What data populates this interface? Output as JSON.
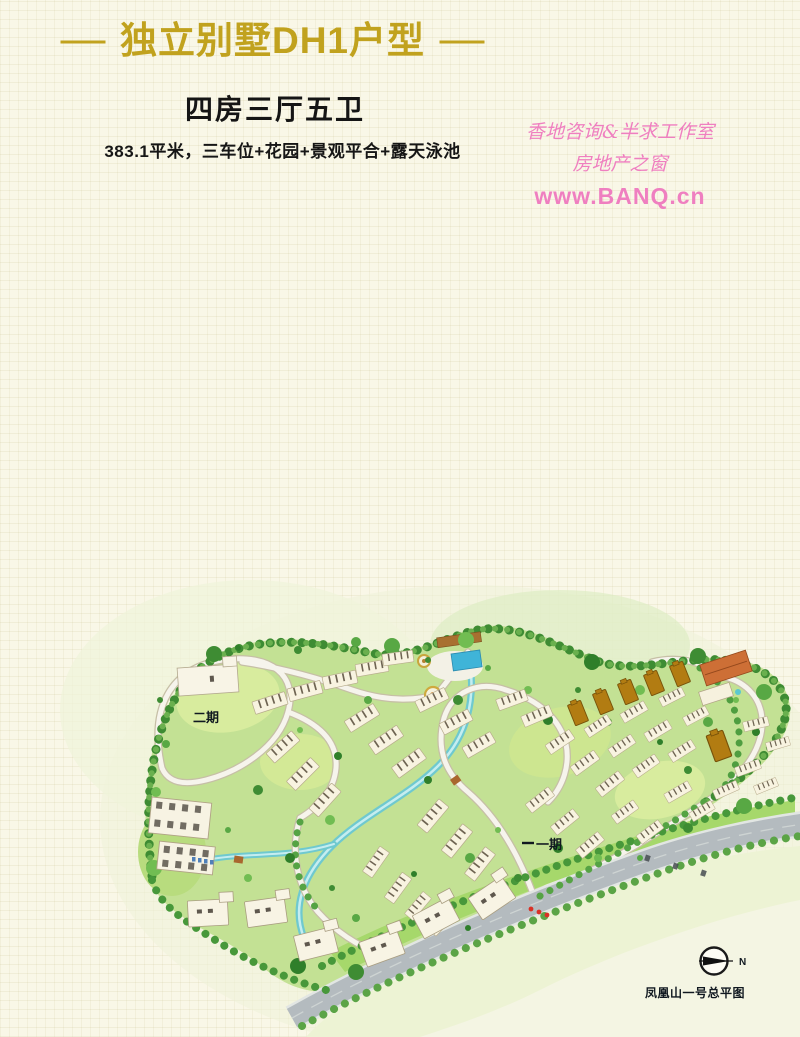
{
  "header": {
    "dash_left": "—",
    "title": "独立别墅DH1户型",
    "dash_right": "—",
    "subtitle": "四房三厅五卫",
    "specs": "383.1平米，三车位+花园+景观平合+露天泳池"
  },
  "watermark": {
    "line1": "香地咨询&半求工作室",
    "line2": "房地产之窗",
    "line3": "www.BANQ.cn",
    "color": "#ef7fc0"
  },
  "siteplan": {
    "phase2_label": "二期",
    "phase1_label": "一期",
    "caption": "凤凰山一号总平图",
    "compass_letter": "N"
  },
  "colors": {
    "title_gold": "#c1a21e",
    "watermark_pink": "#ef7fc0",
    "paper": "#f9f7e7"
  }
}
